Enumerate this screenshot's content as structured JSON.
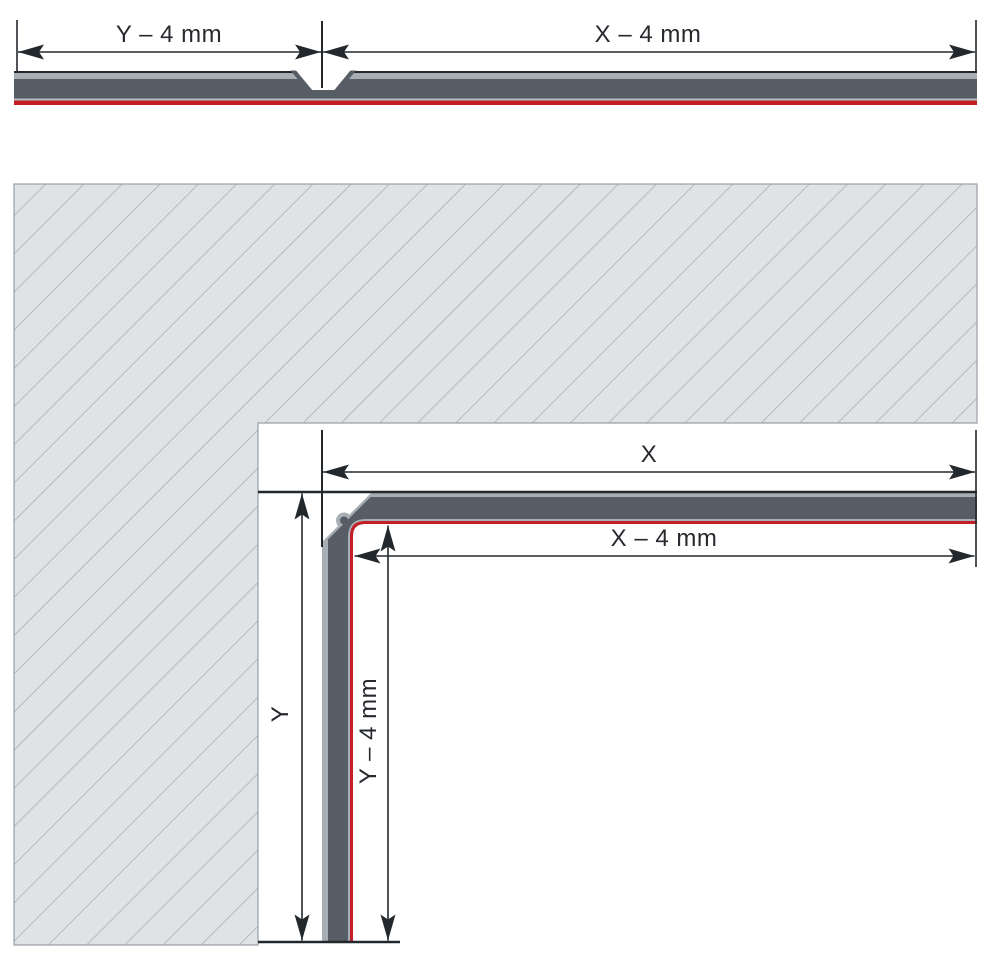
{
  "diagram": {
    "title_semantic": "panel-routing-and-folding-dimension-diagram",
    "top_section": {
      "left_dim_label": "Y – 4 mm",
      "right_dim_label": "X – 4 mm"
    },
    "corner_section": {
      "x_label": "X",
      "x_minus_label": "X – 4 mm",
      "y_label": "Y",
      "y_minus_label": "Y – 4 mm"
    },
    "colors": {
      "core_gray": "#565d64",
      "skin_gray": "#a7afb4",
      "inner_skin_light": "#b6bcc0",
      "red_face": "#c41f27",
      "hatch_bg": "#dfe3e5",
      "hatch_line": "#a6adb2",
      "hatch_border": "#9aa1a6",
      "line_dark": "#23282d"
    }
  }
}
